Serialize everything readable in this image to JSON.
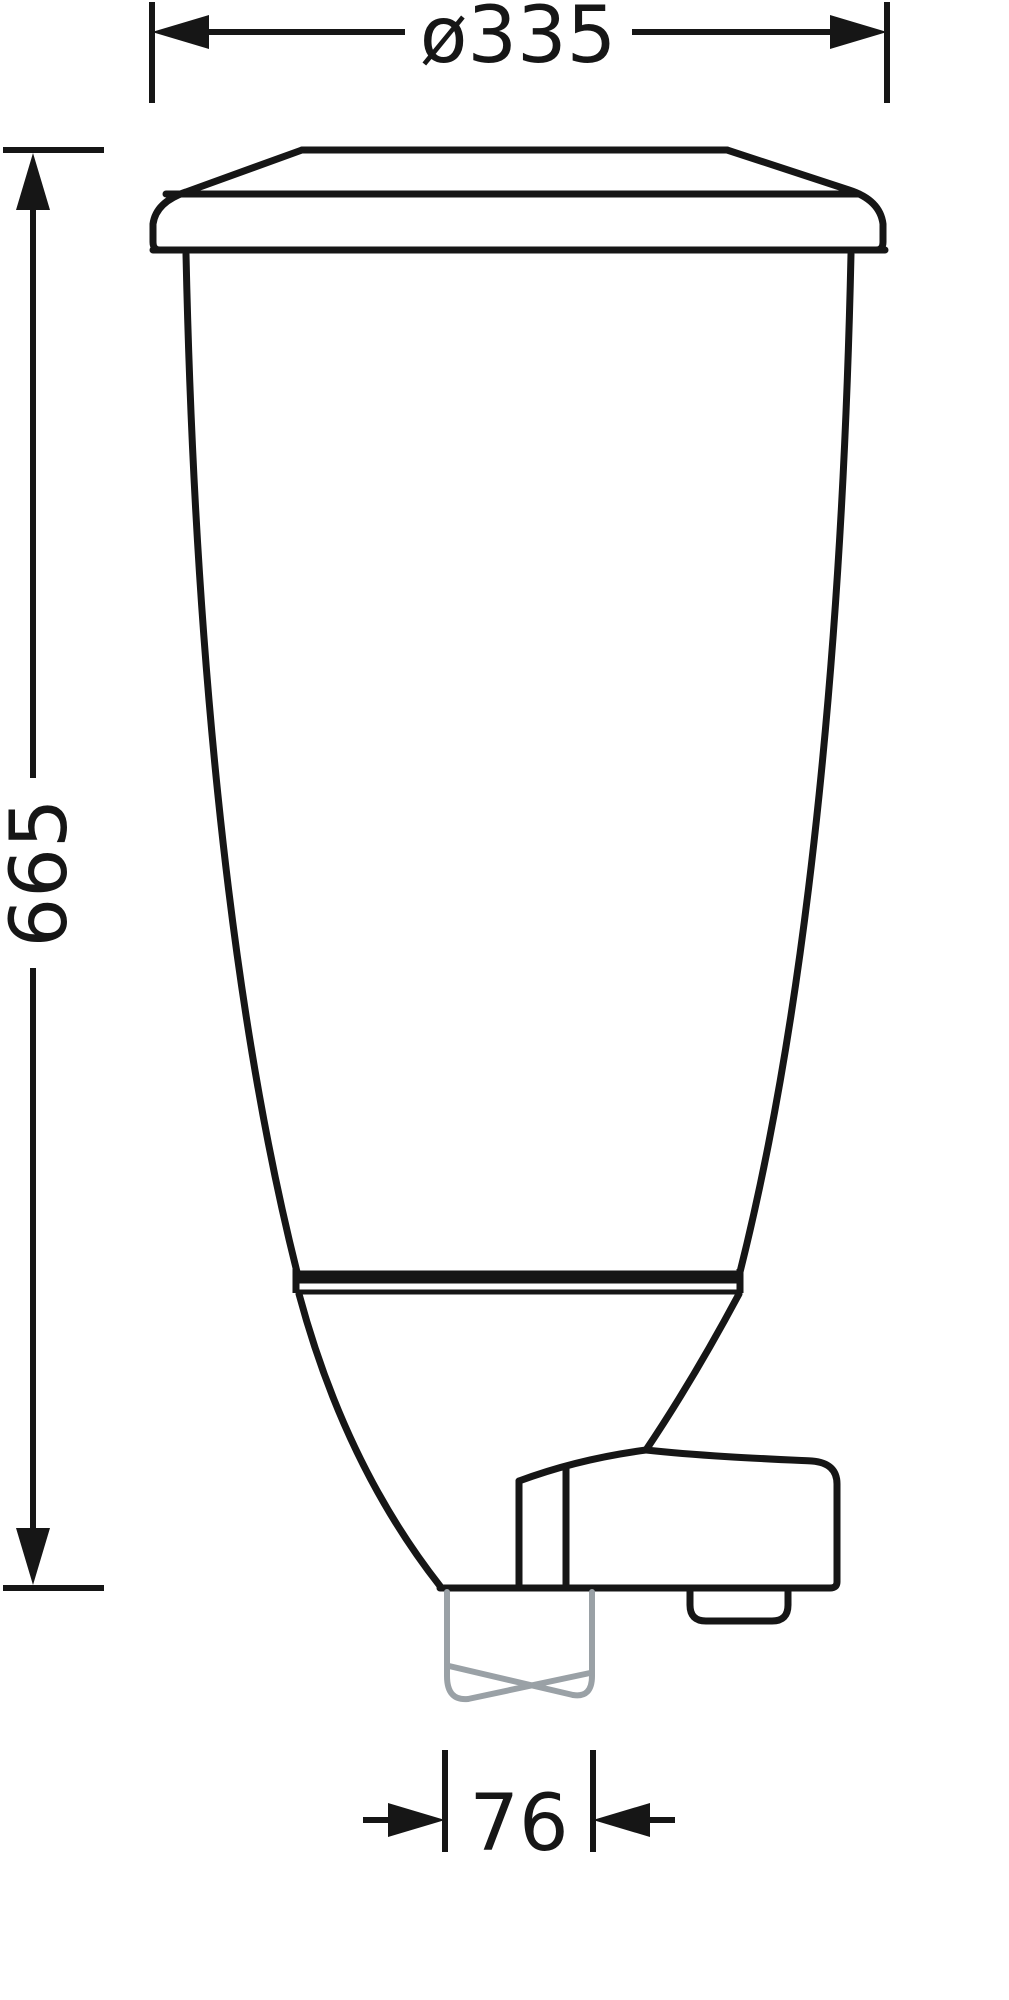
{
  "drawing": {
    "title": "dispenser-technical-drawing",
    "dimensions": {
      "diameter_label": "ø335",
      "height_label": "665",
      "outlet_width_label": "76"
    },
    "colors": {
      "outline": "#161616",
      "outlet_tube": "#9aa1a6",
      "background": "#ffffff"
    }
  }
}
